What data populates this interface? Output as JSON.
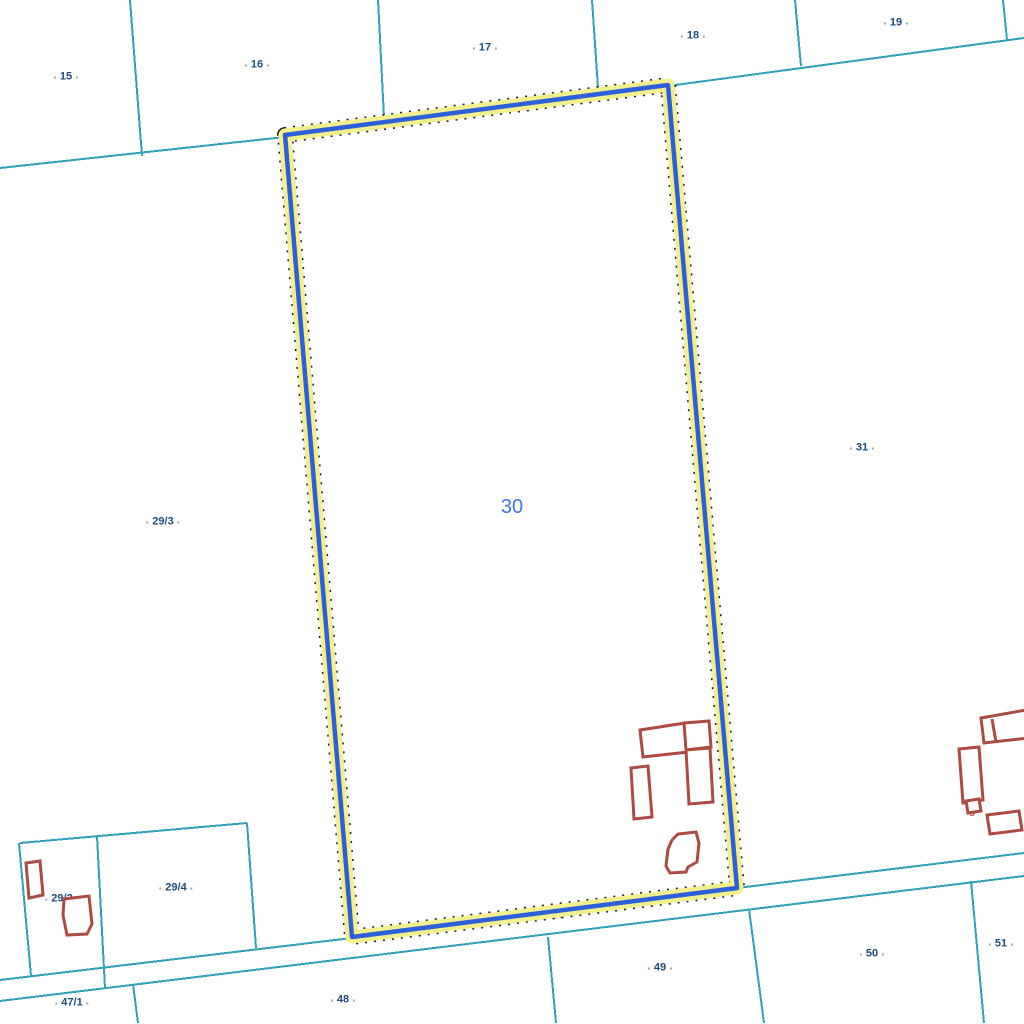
{
  "colors": {
    "boundary_cyan": "#2da2ba",
    "parcel_label_navy": "#1c4b7a",
    "selected_label_blue": "#3d76f2",
    "highlight_blue": "#2d60d8",
    "highlight_halo_yellow": "#f2ef8e",
    "building_red": "#ad4a42",
    "building_label_red": "#e5372e",
    "house_number_blue": "#3a63cf",
    "road_label_gray": "#8b8d75"
  },
  "parcels": {
    "selected": {
      "number": "30"
    },
    "labels": [
      {
        "id": "15",
        "text": "15"
      },
      {
        "id": "16",
        "text": "16"
      },
      {
        "id": "17",
        "text": "17"
      },
      {
        "id": "18",
        "text": "18"
      },
      {
        "id": "19",
        "text": "19"
      },
      {
        "id": "31",
        "text": "31"
      },
      {
        "id": "29/3",
        "text": "29/3"
      },
      {
        "id": "29/2",
        "text": "29/2"
      },
      {
        "id": "29/4",
        "text": "29/4"
      },
      {
        "id": "47/1",
        "text": "47/1"
      },
      {
        "id": "48",
        "text": "48"
      },
      {
        "id": "49",
        "text": "49"
      },
      {
        "id": "50",
        "text": "50"
      },
      {
        "id": "51",
        "text": "51"
      }
    ],
    "road_label": {
      "text": "34"
    }
  },
  "buildings": {
    "use_letter_labels": [
      {
        "text": "g"
      },
      {
        "text": "g"
      },
      {
        "text": "g"
      },
      {
        "text": "g"
      },
      {
        "text": "g"
      },
      {
        "text": "g"
      },
      {
        "text": "g"
      },
      {
        "text": "g"
      },
      {
        "text": "g"
      },
      {
        "text": "g"
      }
    ],
    "note_label": {
      "text": "m"
    },
    "house_numbers": [
      {
        "text": "57"
      },
      {
        "text": "58"
      }
    ]
  }
}
